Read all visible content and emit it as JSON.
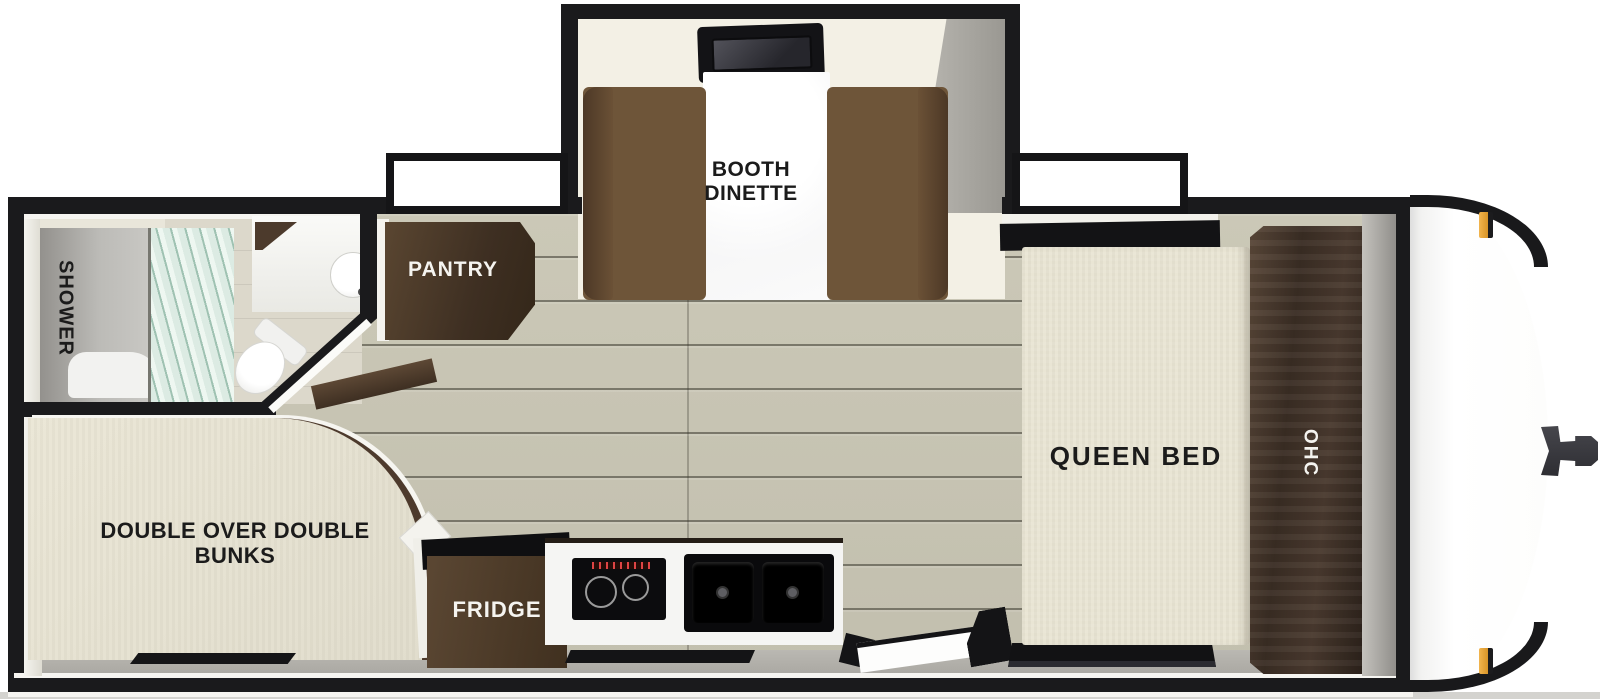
{
  "title": "Travel trailer floor plan",
  "labels": {
    "booth_dinette": [
      "BOOTH",
      "DINETTE"
    ],
    "pantry": "PANTRY",
    "shower": "SHOWER",
    "bunks": [
      "DOUBLE OVER DOUBLE",
      "BUNKS"
    ],
    "fridge": "FRIDGE",
    "queen_bed": "QUEEN BED",
    "ohc": "OHC"
  },
  "palette": {
    "wall_black": "#1a1a1c",
    "cabinet_brown": "#4a3828",
    "bench_brown": "#6e5539",
    "mattress_cream": "#e9e5d4",
    "floor_plank": "#c7c4b3",
    "slideout_floor": "#f3f0e5",
    "shadow_gray": "#a5a39d",
    "marker_amber": "#e8a63e",
    "exterior_white": "#ffffff"
  }
}
